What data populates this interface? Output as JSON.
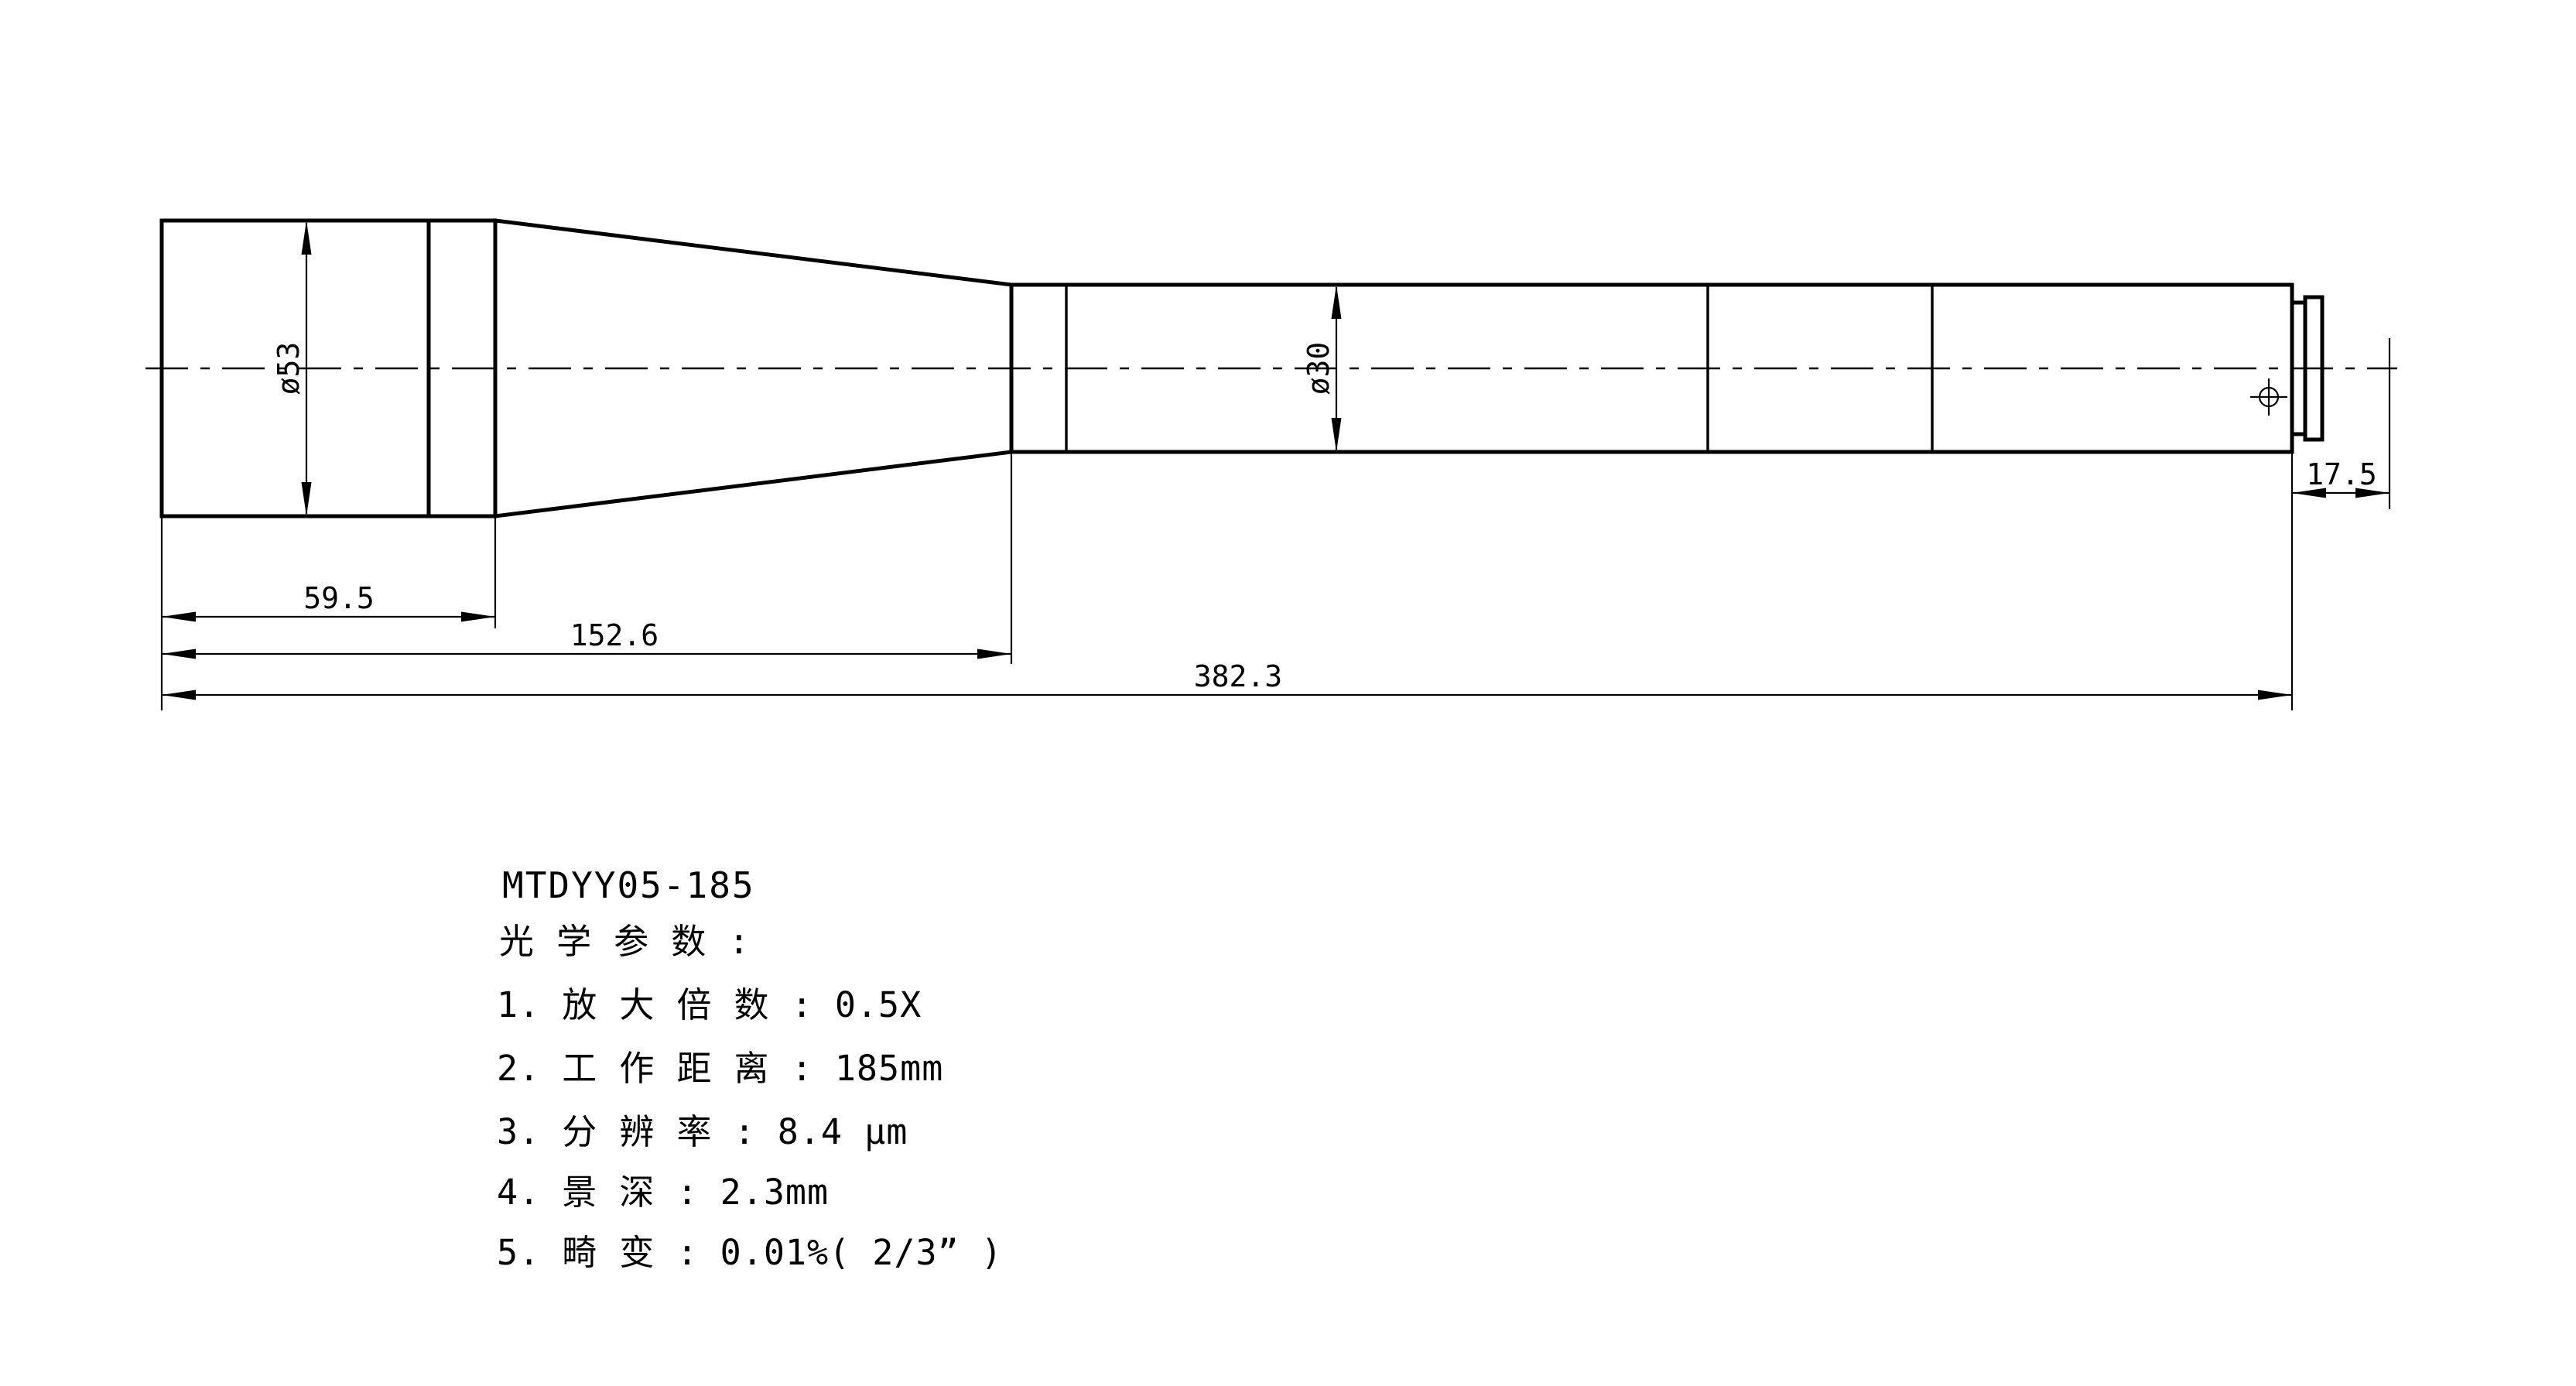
{
  "drawing": {
    "model": "MTDYY05-185",
    "spec_heading": "光 学 参 数 :",
    "specs": [
      "1. 放 大 倍 数 : 0.5X",
      "2. 工 作 距 离 : 185mm",
      "3. 分 辨 率 : 8.4 μm",
      "4. 景 深 : 2.3mm",
      "5. 畸 变 : 0.01%( 2/3” )"
    ],
    "dimensions": {
      "front_diameter": "ø53",
      "tube_diameter": "ø30",
      "front_length": "59.5",
      "front_plus_taper_length": "152.6",
      "total_length": "382.3",
      "flange_distance": "17.5"
    },
    "colors": {
      "line": "#000000",
      "background": "#ffffff"
    }
  }
}
